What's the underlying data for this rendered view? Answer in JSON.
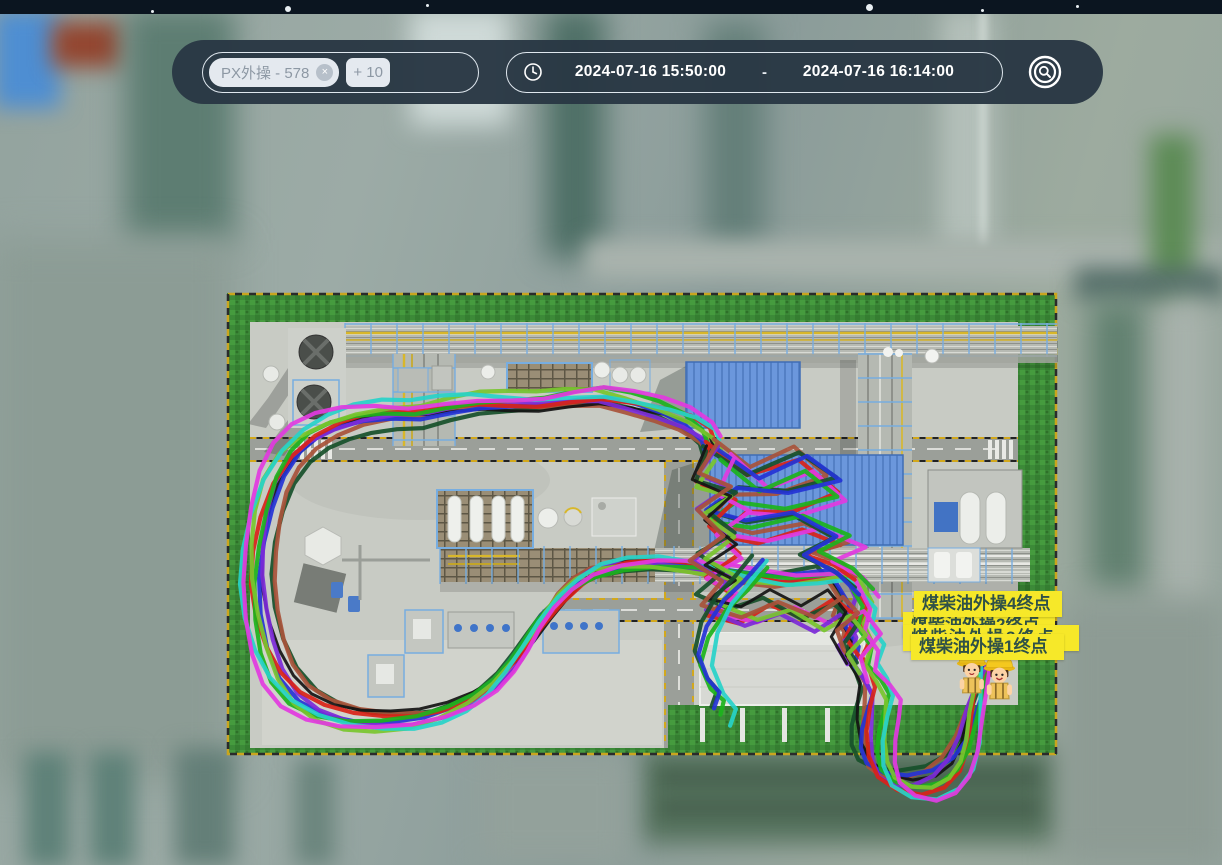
{
  "statusbar": {
    "background": "#0b1520"
  },
  "toolbar": {
    "background": "#293844",
    "tag": {
      "label": "PX外操 - 578",
      "close_icon": "×"
    },
    "more_tag": {
      "label": "+ 10"
    },
    "time_range": {
      "start": "2024-07-16 15:50:00",
      "separator": "-",
      "end": "2024-07-16 16:14:00"
    },
    "locate_button": {
      "name": "locate-search"
    }
  },
  "map": {
    "endpoint_labels": [
      {
        "text": "煤柴油外操4终点",
        "obscured": false
      },
      {
        "text": "煤柴油外操2终点",
        "obscured": true
      },
      {
        "text": "煤柴油外操3终点",
        "obscured": true
      },
      {
        "text": "煤柴油外操1终点",
        "obscured": false
      }
    ],
    "label_style": {
      "bg": "#f6e829",
      "fg": "#2f5147"
    },
    "trajectory_colors": [
      "#17502a",
      "#a8523a",
      "#141414",
      "#2433d6",
      "#7c2ad8",
      "#d92318",
      "#1cb31c",
      "#78c62e",
      "#27d2c9",
      "#e23adf"
    ],
    "worker_avatars": 2
  }
}
